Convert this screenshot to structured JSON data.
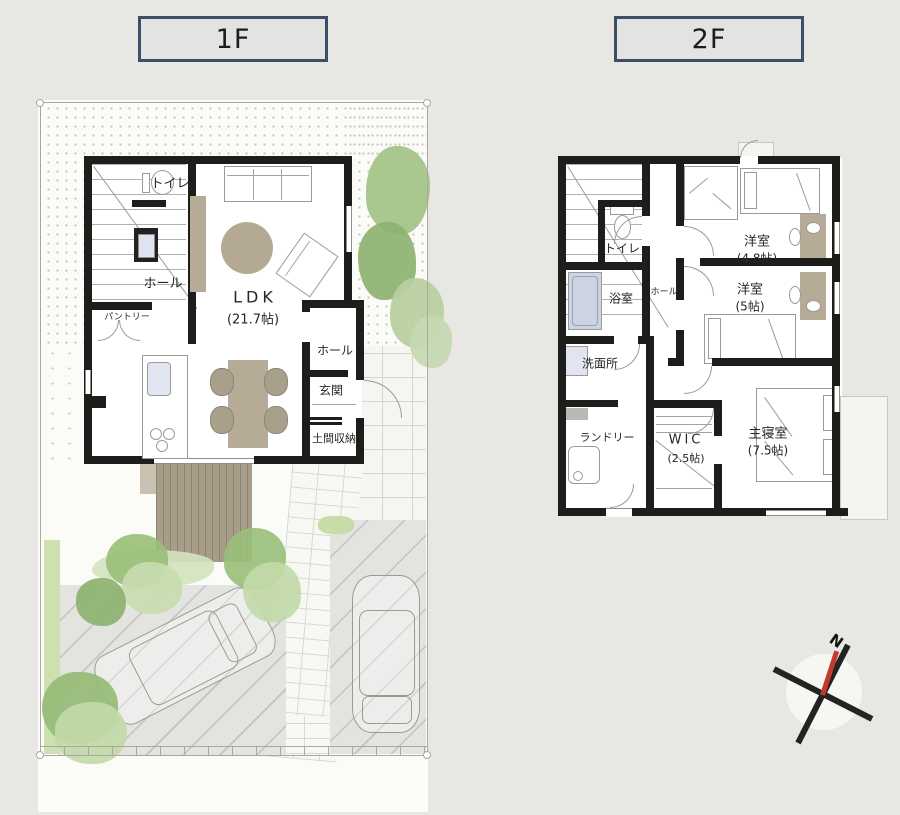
{
  "titles": {
    "floor1": "1F",
    "floor2": "2F"
  },
  "floor1": {
    "labels": {
      "toilet": "トイレ",
      "hall": "ホール",
      "pantry": "パントリー",
      "ldk": "LDK",
      "ldk_size": "(21.7帖)",
      "hall2": "ホール",
      "entrance": "玄関",
      "doma_storage": "土間収納"
    }
  },
  "floor2": {
    "labels": {
      "toilet": "トイレ",
      "bath": "浴室",
      "hall": "ホール",
      "washroom": "洗面所",
      "laundry": "ランドリー",
      "wic": "WIC",
      "wic_size": "(2.5帖)",
      "master_bedroom": "主寝室",
      "master_size": "(7.5帖)",
      "western_room1": "洋室",
      "western_room1_size": "(4.8帖)",
      "western_room2": "洋室",
      "western_room2_size": "(5帖)"
    }
  },
  "compass": {
    "north": "N"
  },
  "colors": {
    "background": "#e8e7e4",
    "wall": "#1d1d1b",
    "title_border": "#3d4f66",
    "tree_green": "#9cc07c",
    "furniture_beige": "#b5ab96",
    "north_needle_red": "#c23a2c"
  }
}
